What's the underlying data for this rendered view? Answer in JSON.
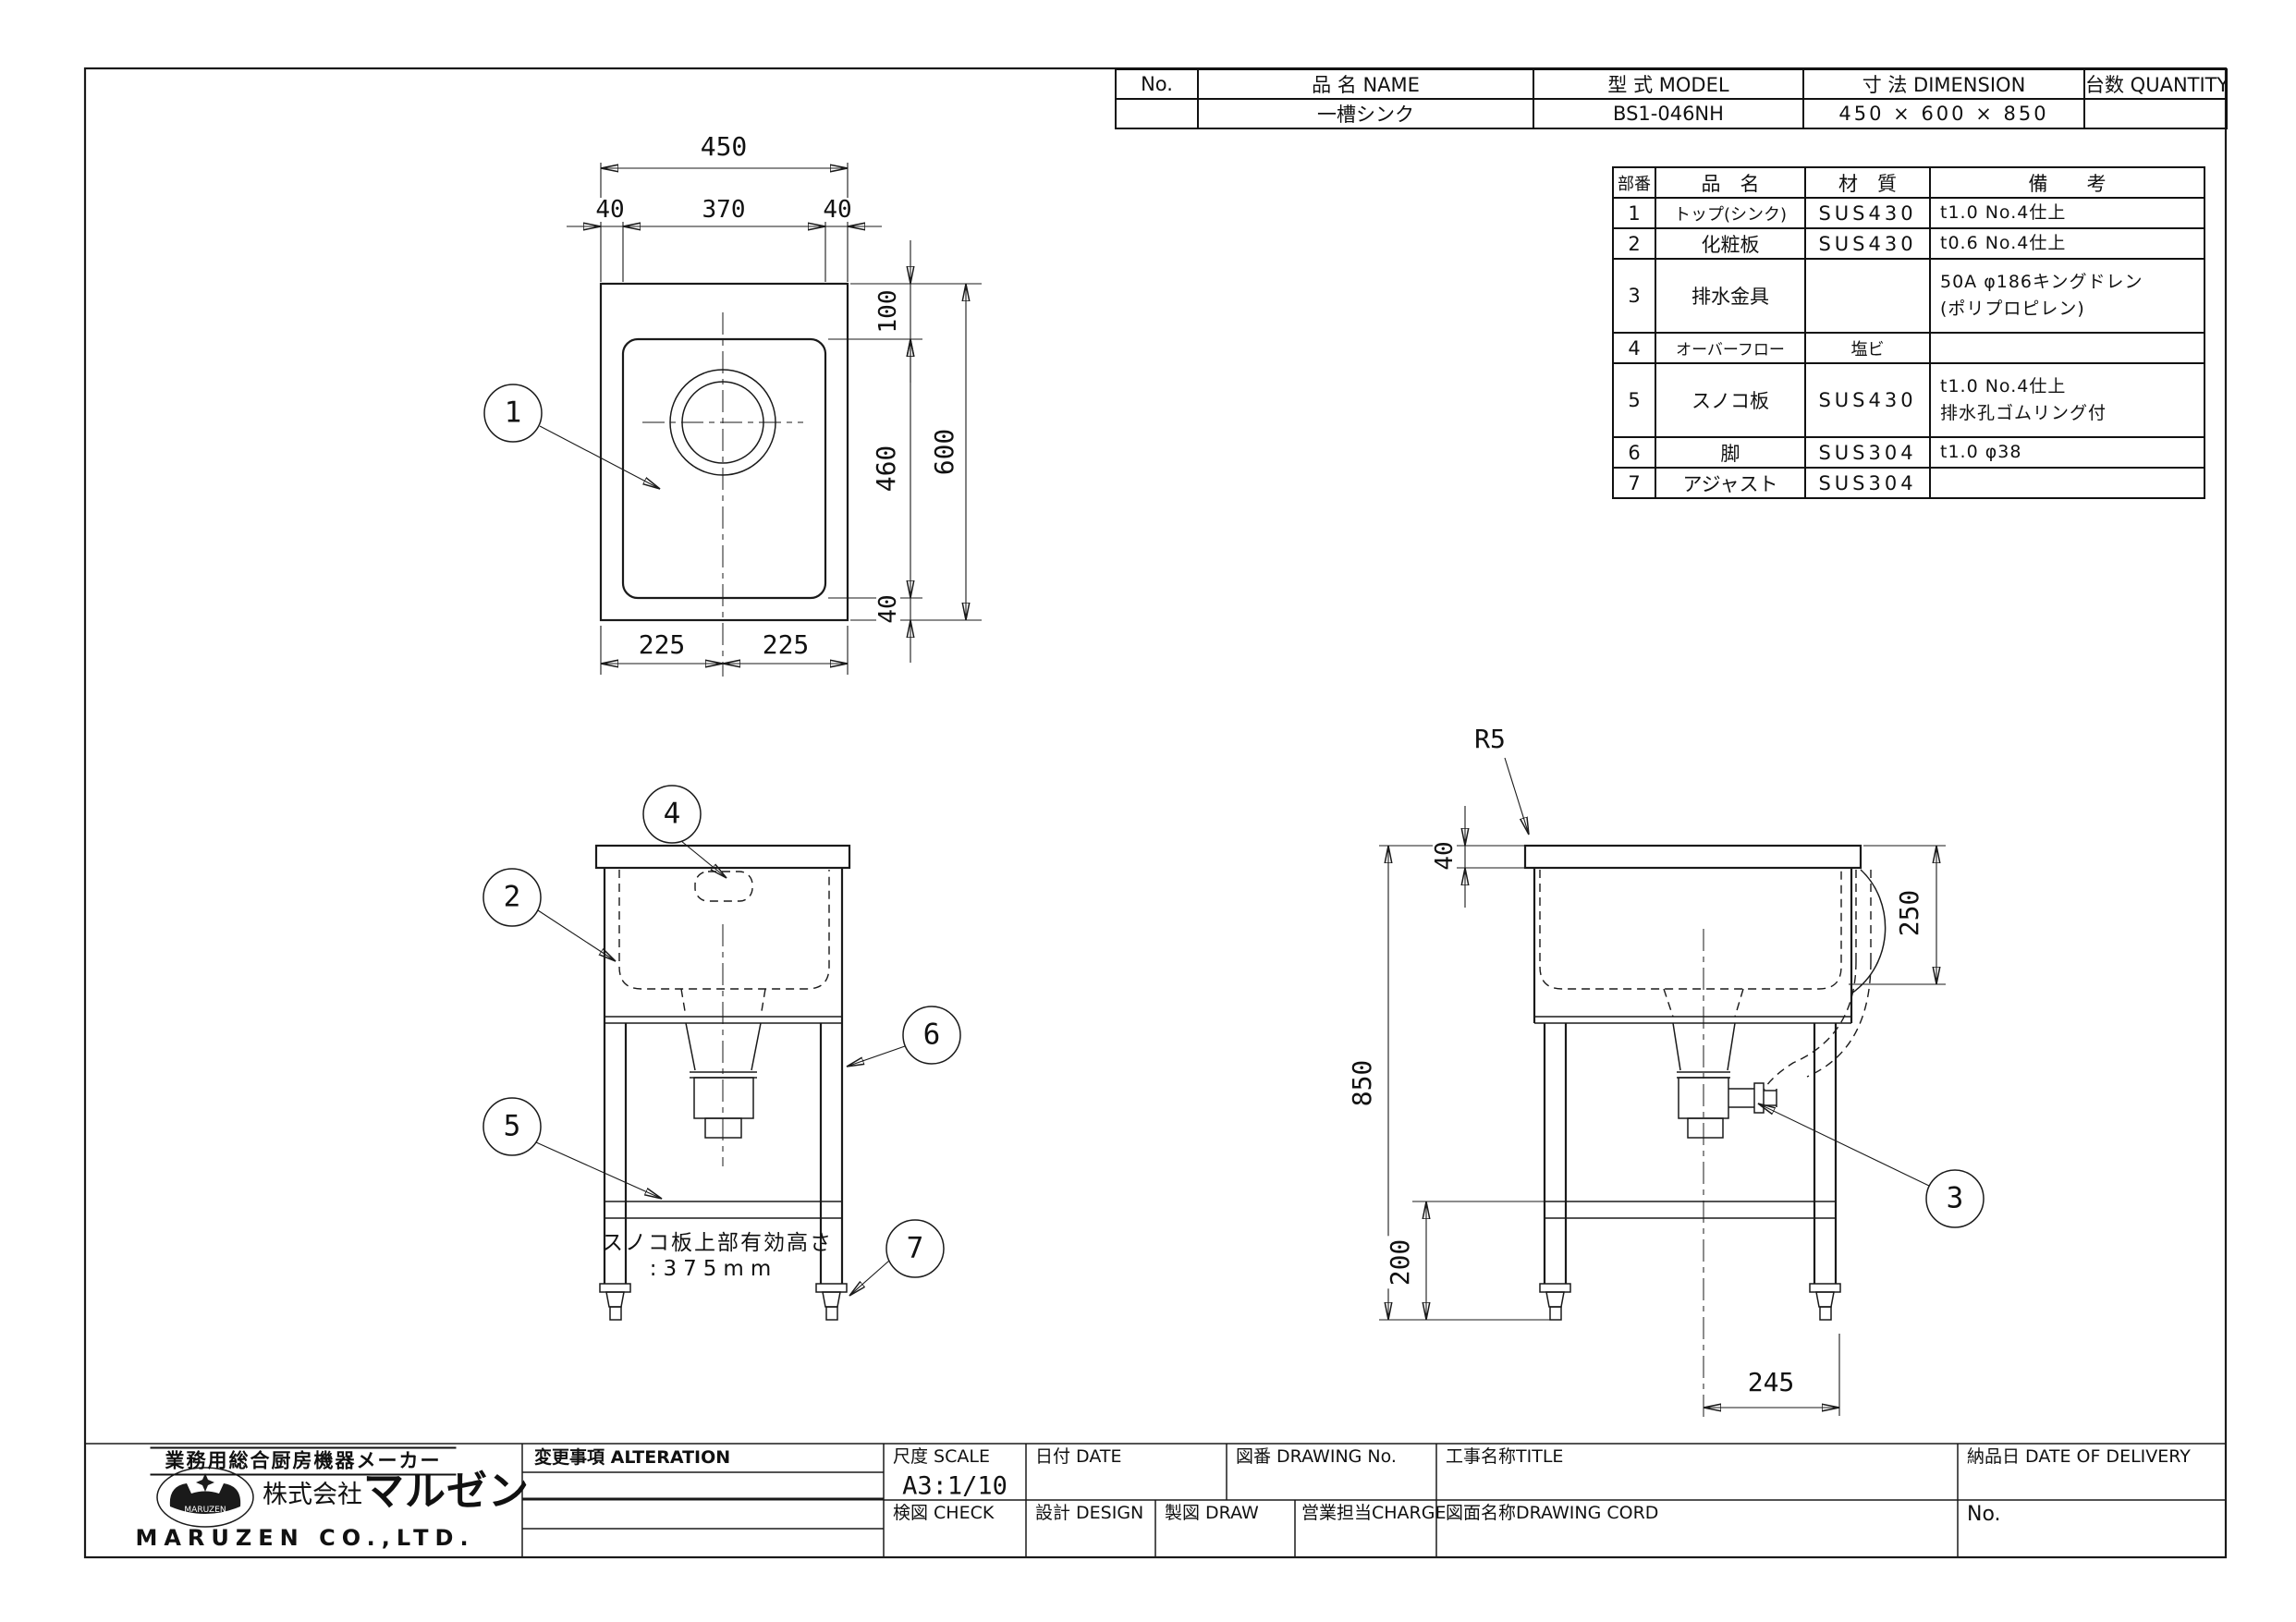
{
  "sheet": {
    "bg": "#ffffff",
    "line_color": "#1a1a1a"
  },
  "header_table": {
    "headers": [
      "No.",
      "品  名  NAME",
      "型  式  MODEL",
      "寸  法  DIMENSION",
      "台数 QUANTITY"
    ],
    "row": {
      "no": "",
      "name": "一槽シンク",
      "model": "BS1-046NH",
      "dimension": "450 × 600 × 850",
      "quantity": ""
    }
  },
  "parts_table": {
    "headers": [
      "部番",
      "品　名",
      "材　質",
      "備　　考"
    ],
    "rows": [
      {
        "no": "1",
        "name": "トップ(シンク)",
        "material": "SUS430",
        "remark": "t1.0 No.4仕上",
        "remark2": ""
      },
      {
        "no": "2",
        "name": "化粧板",
        "material": "SUS430",
        "remark": "t0.6 No.4仕上",
        "remark2": ""
      },
      {
        "no": "3",
        "name": "排水金具",
        "material": "",
        "remark": "50A φ186キングドレン",
        "remark2": "(ポリプロピレン)"
      },
      {
        "no": "4",
        "name": "オーバーフロー",
        "material": "塩ビ",
        "remark": "",
        "remark2": ""
      },
      {
        "no": "5",
        "name": "スノコ板",
        "material": "SUS430",
        "remark": "t1.0 No.4仕上",
        "remark2": "排水孔ゴムリング付"
      },
      {
        "no": "6",
        "name": "脚",
        "material": "SUS304",
        "remark": "t1.0 φ38",
        "remark2": ""
      },
      {
        "no": "7",
        "name": "アジャスト",
        "material": "SUS304",
        "remark": "",
        "remark2": ""
      }
    ]
  },
  "dims": {
    "plan": {
      "width": "450",
      "left_edge": "40",
      "inner_width": "370",
      "right_edge": "40",
      "top_inset": "100",
      "sink_length": "460",
      "depth": "600",
      "bottom_inset": "40",
      "half_left": "225",
      "half_right": "225"
    },
    "side": {
      "corner_radius": "R5",
      "top_height": "40",
      "bowl_depth": "250",
      "overall_height": "850",
      "shelf_height": "200",
      "drain_offset": "245"
    }
  },
  "front_view": {
    "note_line1": "スノコ板上部有効高さ",
    "note_line2": ":375mm"
  },
  "callouts": {
    "c1": "1",
    "c2": "2",
    "c3": "3",
    "c4": "4",
    "c5": "5",
    "c6": "6",
    "c7": "7"
  },
  "title_block": {
    "maker_tagline": "業務用総合厨房機器メーカー",
    "company_prefix": "株式会社",
    "brand_logo": "マルゼン",
    "brand_mark_text": "MARUZEN",
    "company_en": "MARUZEN CO.,LTD.",
    "alteration_label": "変更事項  ALTERATION",
    "scale_label": "尺度 SCALE",
    "scale_value": "A3:1/10",
    "date_label": "日付 DATE",
    "drawing_no_label": "図番 DRAWING  No.",
    "title_label": "工事名称TITLE",
    "delivery_label": "納品日  DATE  OF  DELIVERY",
    "check_label": "検図 CHECK",
    "design_label": "設計 DESIGN",
    "draw_label": "製図 DRAW",
    "charge_label": "営業担当CHARGE",
    "drawing_cord_label": "図面名称DRAWING  CORD",
    "no_label": "No."
  }
}
